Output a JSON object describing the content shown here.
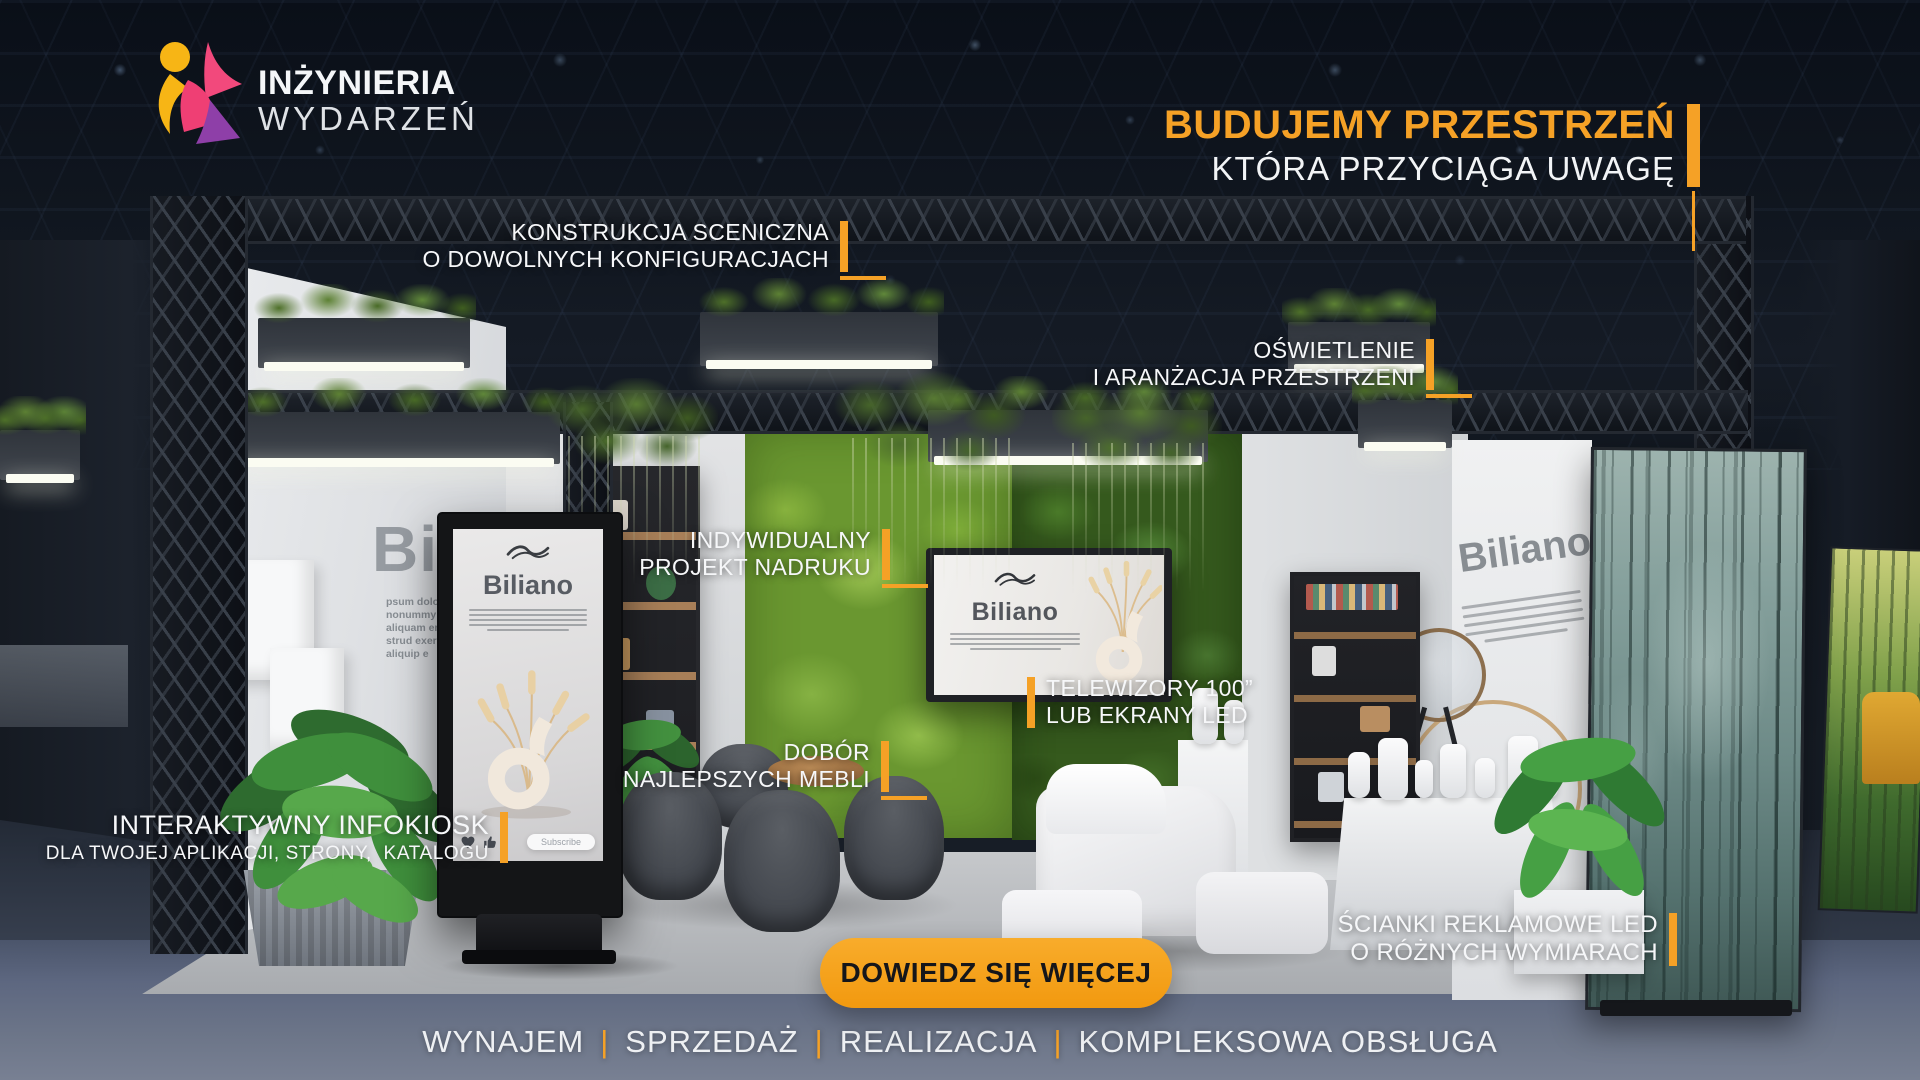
{
  "logo": {
    "line1": "INŻYNIERIA",
    "line2": "WYDARZEŃ"
  },
  "headline": {
    "line1": "BUDUJEMY PRZESTRZEŃ",
    "line2": "KTÓRA PRZYCIĄGA UWAGĘ"
  },
  "callouts": {
    "konstrukcja": {
      "line1": "KONSTRUKCJA SCENICZNA",
      "line2": "O DOWOLNYCH KONFIGURACJACH"
    },
    "oswietlenie": {
      "line1": "OŚWIETLENIE",
      "line2": "I ARANŻACJA PRZESTRZENI"
    },
    "nadruk": {
      "line1": "INDYWIDUALNY",
      "line2": "PROJEKT NADRUKU"
    },
    "telewizory": {
      "line1": "TELEWIZORY 100”",
      "line2": "LUB EKRANY LED"
    },
    "meble": {
      "line1": "DOBÓR",
      "line2": "NAJLEPSZYCH MEBLI"
    },
    "infokiosk": {
      "line1": "INTERAKTYWNY INFOKIOSK",
      "line2": "DLA TWOJEJ APLIKACJI, STRONY,  KATALOGU"
    },
    "scianki": {
      "line1": "ŚCIANKI REKLAMOWE LED",
      "line2": "O RÓŻNYCH WYMIARACH"
    }
  },
  "cta": {
    "label": "DOWIEDZ SIĘ WIĘCEJ"
  },
  "services": {
    "separator": "|",
    "items": [
      "WYNAJEM",
      "SPRZEDAŻ",
      "REALIZACJA",
      "KOMPLEKSOWA OBSŁUGA"
    ]
  },
  "booth": {
    "kiosk_screen": {
      "brand": "Biliano",
      "button": "Subscribe"
    },
    "tv_screen": {
      "brand": "Biliano"
    },
    "right_wall": {
      "brand": "Biliano"
    },
    "left_wall": {
      "big_text": "Bil",
      "paragraph_lines": [
        "psum dolor sit",
        "nonummy nib",
        "aliquam erat",
        "strud exerci ta",
        "aliquip e"
      ]
    }
  },
  "colors": {
    "accent": "#F5A126",
    "cta_bg": "#F4A01C",
    "cta_text": "#17181C",
    "headline_orange": "#F5A126",
    "text_light": "#F4F6F8"
  }
}
